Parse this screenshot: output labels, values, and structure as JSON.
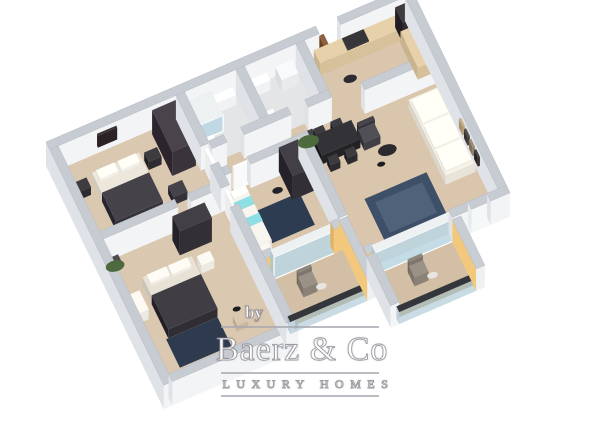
{
  "image": {
    "kind": "3d-floorplan-render",
    "background": "#ffffff"
  },
  "watermark": {
    "by": "by",
    "brand": "Baerz & Co",
    "tagline": "LUXURY HOMES",
    "text_color": "#ffffff",
    "rule_color": "#a8a8af"
  },
  "palette": {
    "wall_top": "#c7ccd2",
    "wall_face": "#f3f4f6",
    "wall_side": "#dfe2e6",
    "balcony_accent_yellow": "#f1c87c",
    "floor_main": "#d9c6ad",
    "floor_bedroom": "#dbc8b0",
    "floor_bath": "#e4e5e7",
    "floor_balcony": "#d2bfa5",
    "furniture_dark": "#332f36",
    "bedding_dark": "#35323a",
    "rug_navy": "#2e3b4e",
    "rug_blue": "#3e5068",
    "accent_teal": "#7ecfd4",
    "sofa_white": "#e9e4da",
    "counter_wood": "#d6c19b",
    "door_wood": "#7d5130",
    "glass": "#9bbec8"
  },
  "floorplan": {
    "proj": {
      "ox": 46,
      "oy": 166,
      "ux": 1.07,
      "uy": -0.46,
      "vx": 0.46,
      "vy": 0.95
    },
    "floor_colors": {
      "floor": "#d9c6ad",
      "floor2": "#dbc8b0",
      "bath": "#e4e5e7",
      "balcony": "#d2bfa5"
    },
    "face_colors": {
      "wall": {
        "t": "#c7ccd2",
        "s": "#f3f4f6",
        "w": "#dfe2e6"
      },
      "yellow": {
        "t": "#c9ced4",
        "s": "#f1c87c",
        "w": "#e0b264"
      },
      "yellowIn": {
        "t": "#c9ced4",
        "s": "#eff0f2",
        "w": "#f1c87c"
      },
      "window": {
        "t": "#c7ccd2",
        "s": "#f5f8f9",
        "w": "#e6ebee"
      },
      "glassDoor": {
        "t": "#eef1f2",
        "s": "rgba(186,214,226,0.85)",
        "w": "rgba(166,196,210,0.8)"
      },
      "glassRail": {
        "t": "#33373c",
        "s": "rgba(150,185,200,0.5)",
        "w": "rgba(130,168,184,0.48)"
      }
    },
    "floors": [
      [
        118,
        8,
        214,
        202,
        "floor"
      ],
      [
        8,
        8,
        110,
        90,
        "floor2"
      ],
      [
        8,
        106,
        110,
        142,
        "floor2"
      ],
      [
        126,
        8,
        48,
        52,
        "bath"
      ],
      [
        182,
        8,
        48,
        52,
        "bath"
      ],
      [
        126,
        184,
        72,
        48,
        "balcony"
      ],
      [
        214,
        218,
        72,
        46,
        "balcony"
      ]
    ],
    "rugs": [
      [
        28,
        196,
        48,
        30,
        "#2e3b4e"
      ],
      [
        146,
        118,
        40,
        34,
        "#2d3c50"
      ],
      [
        234,
        148,
        58,
        46,
        "#3e5068"
      ],
      [
        241,
        155,
        44,
        32,
        "#50617a"
      ]
    ],
    "boxes": [
      [
        0,
        0,
        252,
        8,
        24,
        "wall"
      ],
      [
        272,
        0,
        68,
        8,
        24,
        "wall"
      ],
      [
        0,
        8,
        8,
        248,
        24,
        "wall"
      ],
      [
        8,
        248,
        118,
        8,
        24,
        "wall"
      ],
      [
        332,
        8,
        8,
        202,
        24,
        "wall"
      ],
      [
        8,
        98,
        70,
        8,
        24,
        "wall"
      ],
      [
        90,
        98,
        28,
        8,
        24,
        "wall"
      ],
      [
        118,
        8,
        8,
        54,
        24,
        "wall"
      ],
      [
        118,
        82,
        8,
        24,
        24,
        "wall"
      ],
      [
        118,
        126,
        8,
        122,
        24,
        "wall"
      ],
      [
        174,
        8,
        8,
        52,
        24,
        "wall"
      ],
      [
        230,
        8,
        8,
        52,
        24,
        "wall"
      ],
      [
        126,
        60,
        14,
        8,
        24,
        "wall"
      ],
      [
        156,
        60,
        44,
        8,
        24,
        "wall"
      ],
      [
        216,
        60,
        22,
        8,
        24,
        "wall"
      ],
      [
        126,
        88,
        6,
        8,
        24,
        "wall"
      ],
      [
        150,
        88,
        48,
        8,
        24,
        "wall"
      ],
      [
        198,
        88,
        8,
        88,
        24,
        "wall"
      ],
      [
        266,
        66,
        66,
        8,
        24,
        "wall"
      ],
      [
        286,
        210,
        18,
        8,
        24,
        "wall"
      ],
      [
        322,
        210,
        18,
        8,
        24,
        "wall"
      ],
      [
        304,
        210,
        18,
        8,
        24,
        "window"
      ],
      [
        126,
        176,
        8,
        8,
        24,
        "yellow"
      ],
      [
        190,
        176,
        8,
        8,
        24,
        "yellow"
      ],
      [
        206,
        210,
        8,
        8,
        24,
        "yellow"
      ],
      [
        198,
        176,
        8,
        62,
        22,
        "yellowIn"
      ],
      [
        206,
        218,
        8,
        52,
        22,
        "wall"
      ],
      [
        286,
        218,
        8,
        52,
        22,
        "yellowIn"
      ],
      [
        134,
        176,
        56,
        8,
        22,
        "glassDoor"
      ],
      [
        214,
        210,
        72,
        8,
        22,
        "glassDoor"
      ],
      [
        126,
        232,
        72,
        6,
        12,
        "glassRail"
      ],
      [
        214,
        264,
        72,
        6,
        12,
        "glassRail"
      ],
      [
        128,
        10,
        22,
        26,
        16,
        "glassDoor"
      ],
      [
        252,
        8,
        4,
        16,
        22,
        "#7d5130"
      ],
      [
        121,
        64,
        3,
        16,
        22,
        "#fafafa"
      ],
      [
        121,
        108,
        3,
        16,
        22,
        "#fafafa"
      ],
      [
        136,
        89,
        16,
        3,
        22,
        "#fafafa"
      ],
      [
        30,
        30,
        44,
        52,
        8,
        "#ddd6ca"
      ],
      [
        30,
        52,
        44,
        30,
        9,
        "#35323a"
      ],
      [
        33,
        32,
        17,
        9,
        3,
        "#f2efe8",
        8
      ],
      [
        53,
        32,
        17,
        9,
        3,
        "#f2efe8",
        8
      ],
      [
        12,
        32,
        12,
        10,
        8,
        "#2e2c31"
      ],
      [
        78,
        32,
        12,
        10,
        8,
        "#2e2c31"
      ],
      [
        94,
        12,
        22,
        44,
        24,
        "#3a333b"
      ],
      [
        84,
        70,
        13,
        12,
        8,
        "#34333a"
      ],
      [
        44,
        8.5,
        18,
        2,
        12,
        "#2b2226",
        8
      ],
      [
        30,
        140,
        46,
        56,
        8,
        "#d8d2c6"
      ],
      [
        30,
        160,
        46,
        36,
        9,
        "#302d34"
      ],
      [
        33,
        142,
        18,
        9,
        3,
        "#efece5",
        8
      ],
      [
        53,
        142,
        18,
        9,
        3,
        "#efece5",
        8
      ],
      [
        80,
        142,
        12,
        10,
        8,
        "#eceae3"
      ],
      [
        70,
        112,
        30,
        16,
        24,
        "#332f36"
      ],
      [
        12,
        152,
        10,
        20,
        10,
        "#eceae3"
      ],
      [
        86,
        206,
        10,
        10,
        6,
        "#c9b7a0"
      ],
      [
        12,
        110,
        8,
        8,
        7,
        "#3c3c42"
      ],
      [
        128,
        100,
        16,
        10,
        8,
        "#e9e6df"
      ],
      [
        128,
        110,
        16,
        8,
        8,
        "#e9e6df"
      ],
      [
        128,
        118,
        16,
        10,
        8,
        "#e9e6df"
      ],
      [
        128,
        128,
        16,
        8,
        8,
        "#e9e6df"
      ],
      [
        128,
        136,
        16,
        20,
        8,
        "#e9e6df"
      ],
      [
        128,
        110,
        16,
        8,
        0.8,
        "#7ecfd4",
        8
      ],
      [
        128,
        128,
        16,
        8,
        0.8,
        "#7ecfd4",
        8
      ],
      [
        129,
        101,
        14,
        7,
        3,
        "#f6f4ee",
        8
      ],
      [
        178,
        92,
        20,
        30,
        24,
        "#322f36"
      ],
      [
        128,
        158,
        12,
        14,
        10,
        "#ebe8e1"
      ],
      [
        152,
        10,
        18,
        8,
        10,
        "#f1f2f3"
      ],
      [
        128,
        42,
        10,
        12,
        8,
        "#f1f2f3"
      ],
      [
        184,
        10,
        18,
        8,
        10,
        "#f1f2f3"
      ],
      [
        210,
        10,
        16,
        14,
        12,
        "#e9eaec"
      ],
      [
        184,
        42,
        10,
        12,
        8,
        "#f1f2f3"
      ],
      [
        246,
        10,
        86,
        14,
        12,
        "#d6c19b"
      ],
      [
        322,
        10,
        10,
        16,
        20,
        "#2f2b31"
      ],
      [
        320,
        26,
        12,
        38,
        12,
        "#d6c19b"
      ],
      [
        272,
        11,
        20,
        12,
        1,
        "#26262a",
        12
      ],
      [
        214,
        82,
        36,
        20,
        9,
        "#232327"
      ],
      [
        218,
        74,
        9,
        8,
        7,
        "#2b2b30"
      ],
      [
        234,
        74,
        9,
        8,
        7,
        "#2b2b30"
      ],
      [
        218,
        104,
        9,
        8,
        7,
        "#2b2b30"
      ],
      [
        234,
        104,
        9,
        8,
        7,
        "#2b2b30"
      ],
      [
        252,
        90,
        15,
        4,
        13,
        "#36343b"
      ],
      [
        252,
        92,
        15,
        14,
        8,
        "#413f46"
      ],
      [
        302,
        86,
        28,
        80,
        9,
        "#e9e4da"
      ],
      [
        303,
        90,
        24,
        24,
        3,
        "#f2efe7",
        9
      ],
      [
        303,
        116,
        24,
        24,
        3,
        "#f2efe7",
        9
      ],
      [
        303,
        142,
        24,
        22,
        3,
        "#f2efe7",
        9
      ],
      [
        208,
        74,
        9,
        9,
        8,
        "#33333a"
      ],
      [
        330,
        86,
        2,
        8,
        9,
        "#3b2f28",
        10
      ],
      [
        330,
        97,
        2,
        8,
        9,
        "#c4b394",
        10
      ],
      [
        330,
        108,
        2,
        8,
        9,
        "#554f49",
        10
      ],
      [
        330,
        119,
        2,
        8,
        9,
        "#2e2a33",
        10
      ],
      [
        330,
        130,
        2,
        8,
        9,
        "#b79f79",
        10
      ],
      [
        330,
        141,
        2,
        8,
        9,
        "#46403c",
        10
      ],
      [
        330,
        152,
        2,
        8,
        9,
        "#8e7f6a",
        10
      ],
      [
        330,
        163,
        2,
        8,
        9,
        "#342f2e",
        10
      ],
      [
        150,
        196,
        13,
        3,
        13,
        "#7d766c"
      ],
      [
        150,
        199,
        13,
        12,
        9,
        "#8a8277"
      ],
      [
        240,
        228,
        13,
        3,
        13,
        "#7d766c"
      ],
      [
        240,
        231,
        13,
        12,
        9,
        "#8a8277"
      ]
    ],
    "discs": [
      [
        268,
        38,
        5,
        "#2c2c31"
      ],
      [
        270,
        114,
        7,
        "#2a2a2f"
      ],
      [
        260,
        124,
        3,
        "#1d1d21"
      ],
      [
        212,
        77,
        8,
        "#4d6a3f"
      ],
      [
        16,
        113,
        7,
        "#4d6a3f"
      ],
      [
        170,
        108,
        4,
        "#232327"
      ],
      [
        168,
        208,
        4,
        "#e8e6e0"
      ],
      [
        258,
        240,
        4,
        "#e8e6e0"
      ],
      [
        94,
        196,
        3,
        "#1d1d21"
      ]
    ]
  }
}
